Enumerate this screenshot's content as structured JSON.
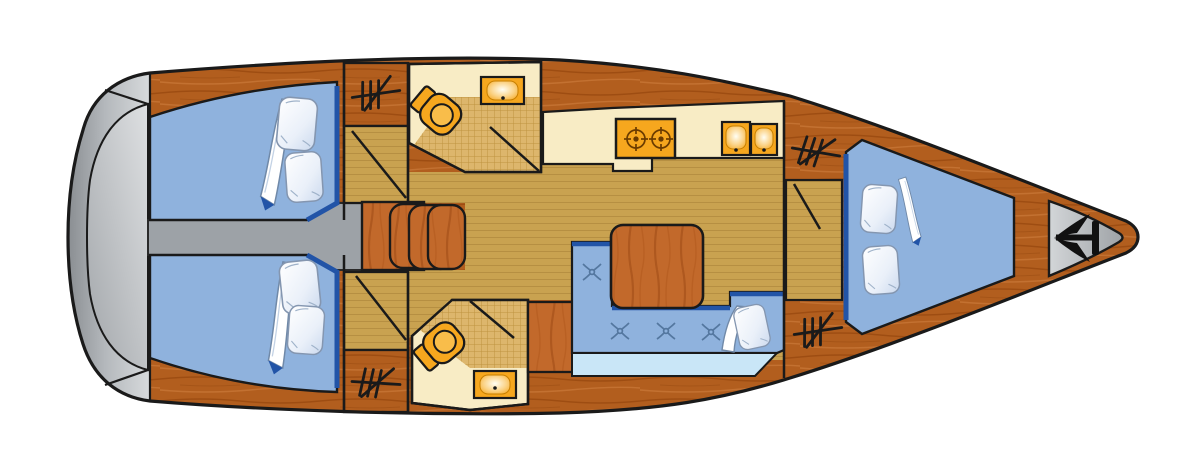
{
  "diagram": {
    "type": "yacht-interior-floor-plan",
    "view": "top-down deck plan",
    "orientation": {
      "bow": "right",
      "stern": "left"
    },
    "rooms": [
      {
        "id": "aft-cabin-port",
        "position": "top-left",
        "berths": 1,
        "pillows": 2,
        "blanket": true
      },
      {
        "id": "aft-cabin-starboard",
        "position": "bottom-left",
        "berths": 1,
        "pillows": 2,
        "blanket": true
      },
      {
        "id": "head-port",
        "position": "top-middle",
        "toilet": 1,
        "sink": 1,
        "shower_floor": true
      },
      {
        "id": "head-starboard",
        "position": "bottom-middle",
        "toilet": 1,
        "sink": 1,
        "shower_floor": true,
        "wardrobe": true
      },
      {
        "id": "salon",
        "position": "center",
        "table": 1,
        "settee_tufts": 4,
        "pillows": 1
      },
      {
        "id": "galley",
        "position": "top-middle-right",
        "stove_burners": 2,
        "sink_basins": 2
      },
      {
        "id": "forward-cabin",
        "position": "right",
        "berths": 1,
        "pillows": 2,
        "blanket": true
      }
    ],
    "features": {
      "hanging_lockers": 4,
      "companionway_steps": 3,
      "swim_platform": "stern (left, gray)",
      "anchor_locker": "bow tip (right, gray)",
      "walkway": "gray corridor from stern to companionway steps"
    },
    "icons": [
      "anchor-icon",
      "hanging-rail-icon",
      "toilet-fixture",
      "sink-basin",
      "stove-burner",
      "tuft-mark"
    ]
  },
  "colors": {
    "hull_wood": "#B25E1E",
    "hull_wood_dark": "#98490F",
    "hull_wood_light": "#C67433",
    "floor_tan": "#C9A250",
    "floor_line": "#B38C3F",
    "hatch_tan": "#DDB66C",
    "hatch_line": "#BE9440",
    "cream": "#F8ECC5",
    "fixture_orange": "#F6A71E",
    "fixture_orange_deep": "#F9BD4A",
    "berth_blue": "#8FB2DD",
    "trim_blue": "#2254A7",
    "backrest_blue": "#C9E6F7",
    "tuft_blue": "#54779F",
    "transom_light": "#D7DADC",
    "transom_dark": "#8A8E92",
    "walkway_gray": "#9DA2A7",
    "table_wood": "#C2692B",
    "table_wood_dark": "#A9541B",
    "outline": "#1A1A1A",
    "anchor_black": "#111111",
    "bg": "#FFFFFF"
  }
}
